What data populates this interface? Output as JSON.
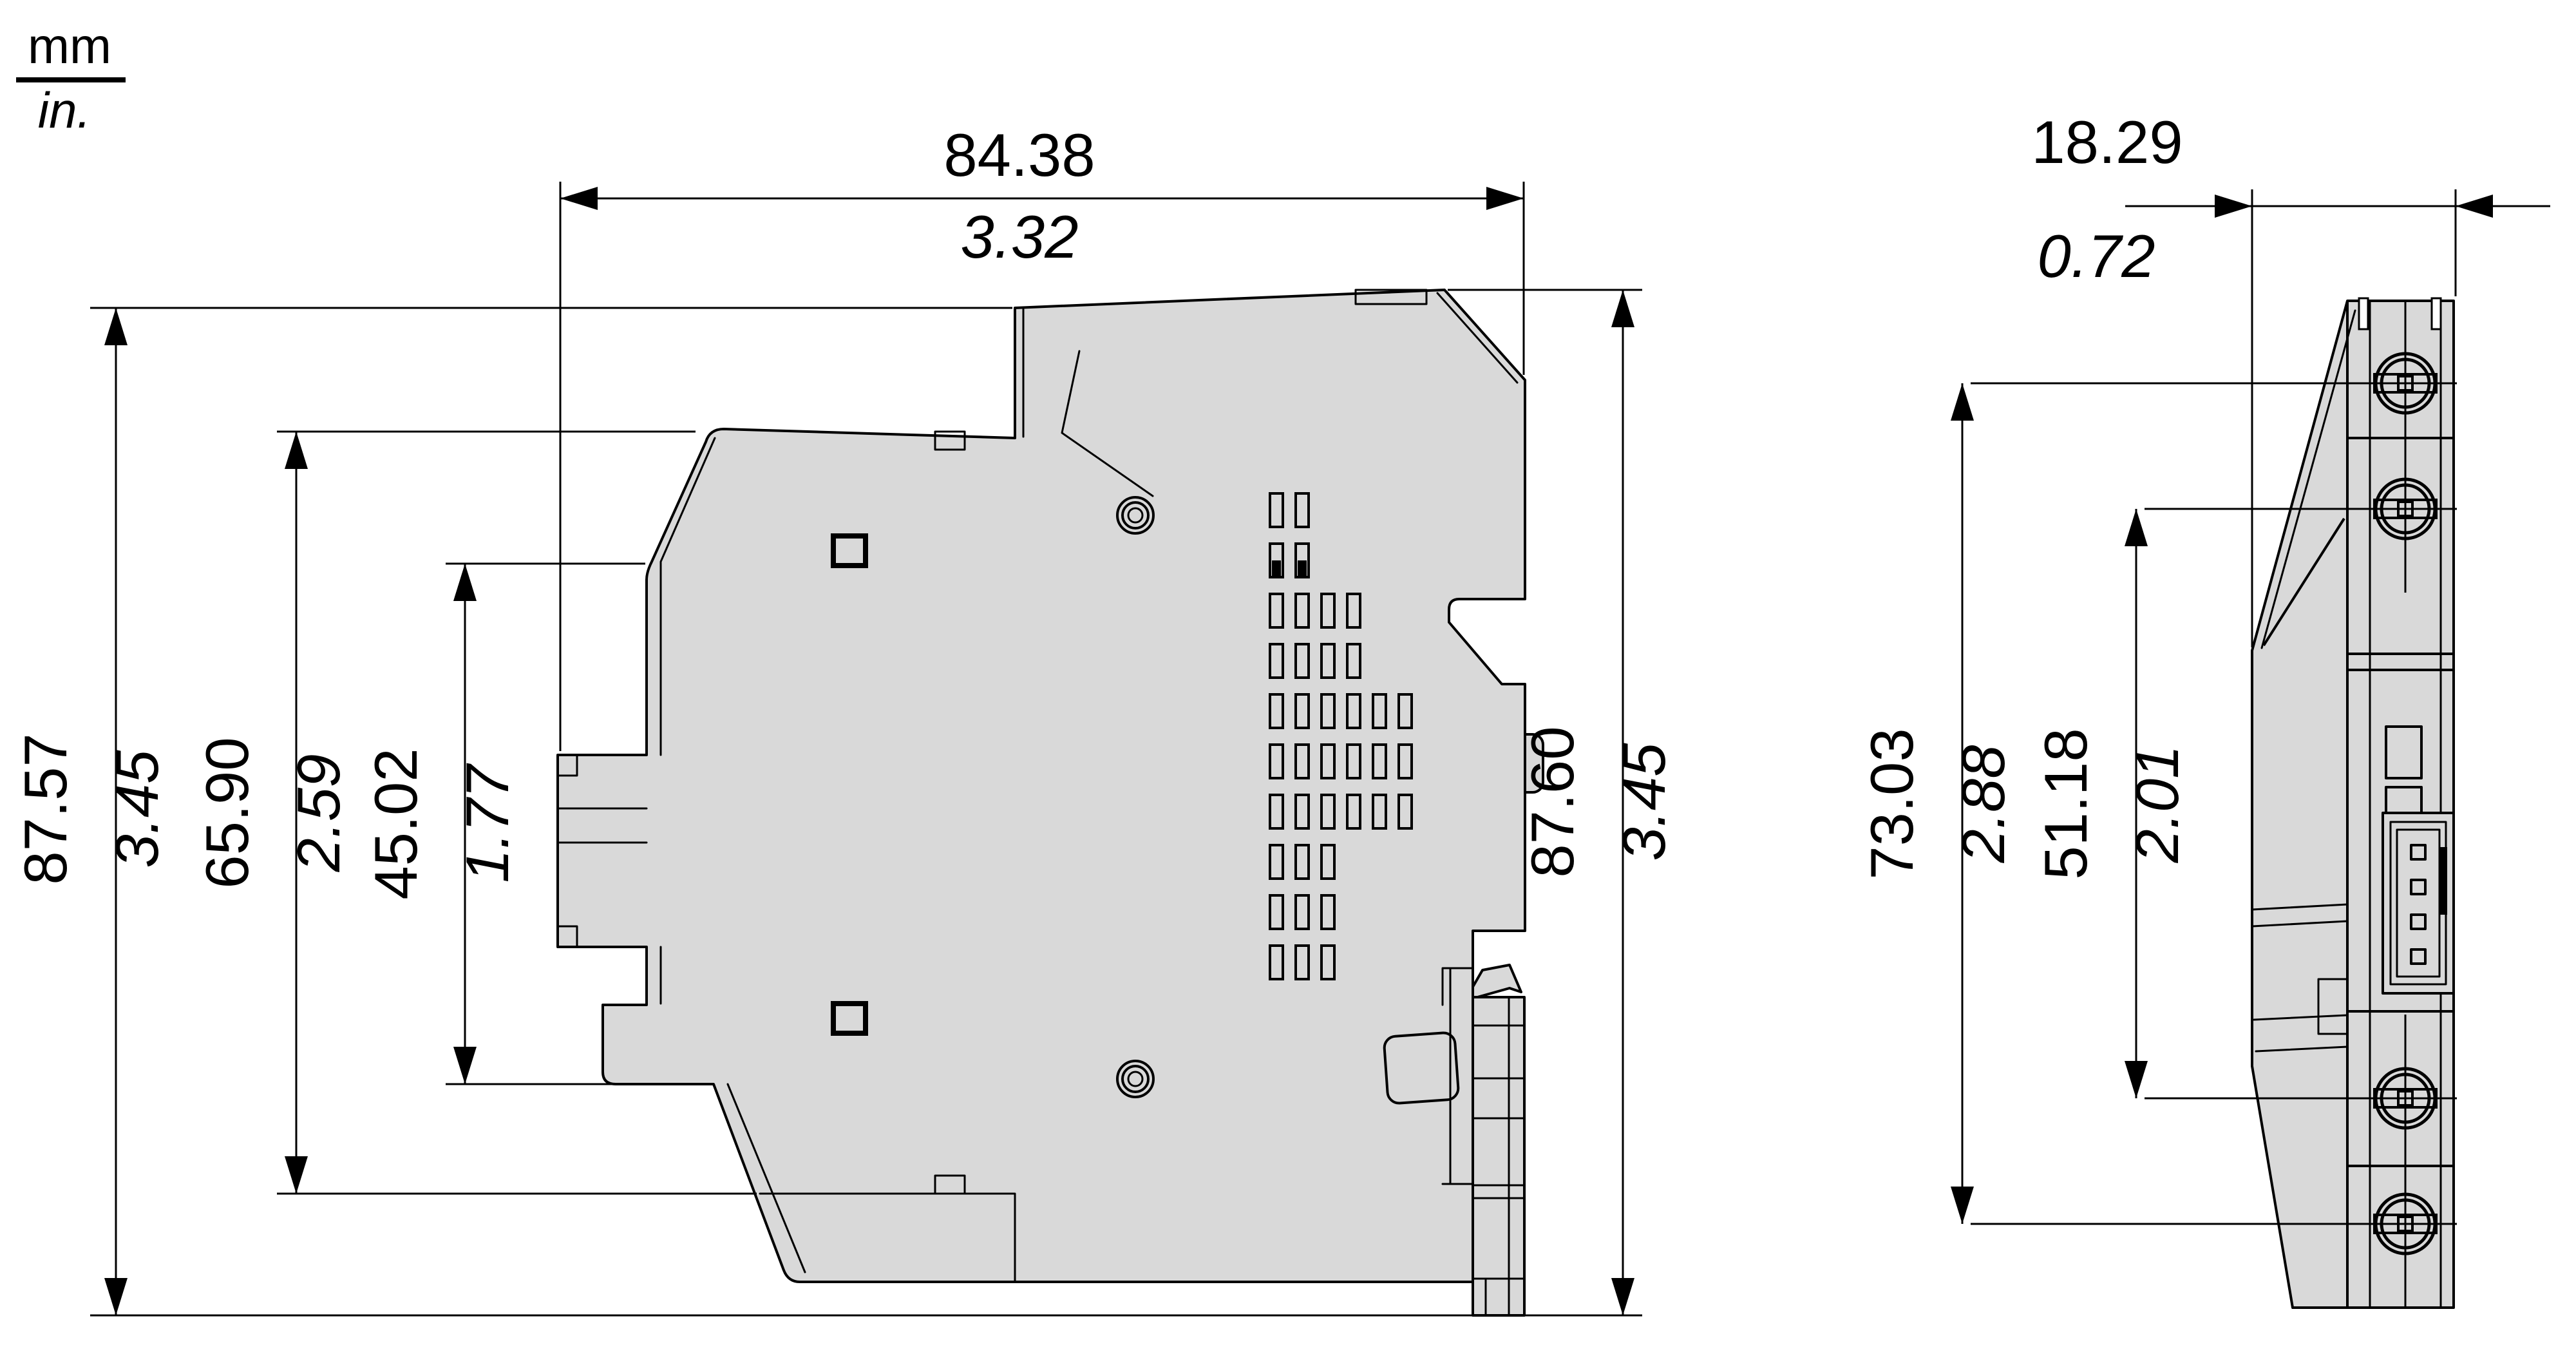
{
  "units": {
    "metric": "mm",
    "imperial": "in."
  },
  "dimensions": {
    "overall_width": {
      "mm": "84.38",
      "in": "3.32"
    },
    "depth": {
      "mm": "18.29",
      "in": "0.72"
    },
    "overall_height_front": {
      "mm": "87.57",
      "in": "3.45"
    },
    "mid_height": {
      "mm": "65.90",
      "in": "2.59"
    },
    "front_face_height": {
      "mm": "45.02",
      "in": "1.77"
    },
    "overall_height_rear": {
      "mm": "87.60",
      "in": "3.45"
    },
    "terminal_span_outer": {
      "mm": "73.03",
      "in": "2.88"
    },
    "terminal_span_inner": {
      "mm": "51.18",
      "in": "2.01"
    }
  },
  "colors": {
    "body_fill": "#d9d9d9",
    "line": "#000000",
    "background": "#ffffff"
  }
}
